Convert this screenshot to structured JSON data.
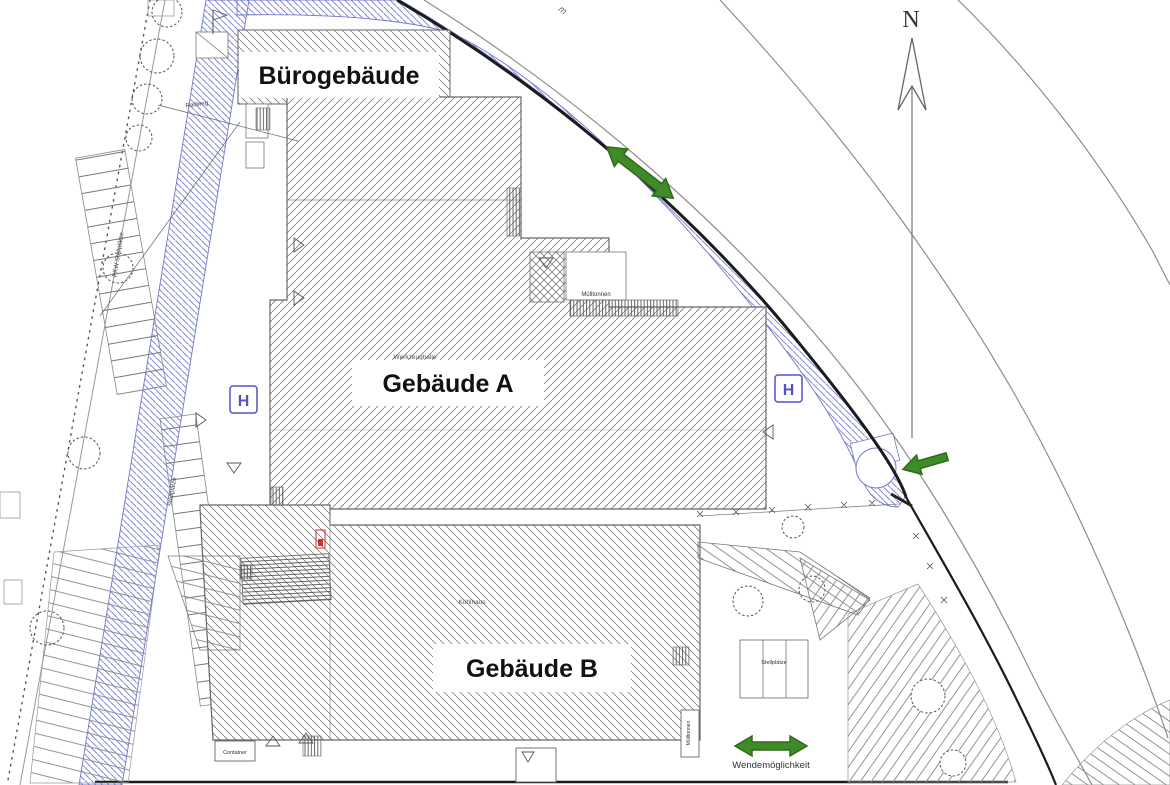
{
  "plan": {
    "buildings": {
      "office": {
        "label": "Bürogebäude"
      },
      "a": {
        "label": "Gebäude A",
        "sublabel": "Werkzeughalle"
      },
      "b": {
        "label": "Gebäude B",
        "sublabel": "Kühlhaus"
      }
    },
    "annotations": {
      "muelltonnen_top": "Mülltonnen",
      "muelltonnen_bottom": "Mülltonnen",
      "container": "Container",
      "stellplaetze_left": "Stellplätze",
      "stellplaetze_right": "Stellplätze",
      "pkw_stellplaetze": "PKW Stellplätze",
      "radweg": "Radweg",
      "wendemoeglichkeit": "Wendemöglichkeit",
      "street_fragment": "m"
    },
    "markers": {
      "north_label": "N",
      "hydrant_left": "H",
      "hydrant_right": "H"
    },
    "colors": {
      "driveway_hatch": "#8a8fd8",
      "driveway_edge": "#7277cc",
      "arrow_fill": "#3e8b28",
      "arrow_stroke": "#2f6a1b",
      "hatch_gray": "#7e7e7e",
      "boundary_dark": "#1b1b1b",
      "street_gray": "#8d8d8d",
      "hydrant_blue": "#5152c8",
      "marker_red": "#cc3333"
    }
  }
}
